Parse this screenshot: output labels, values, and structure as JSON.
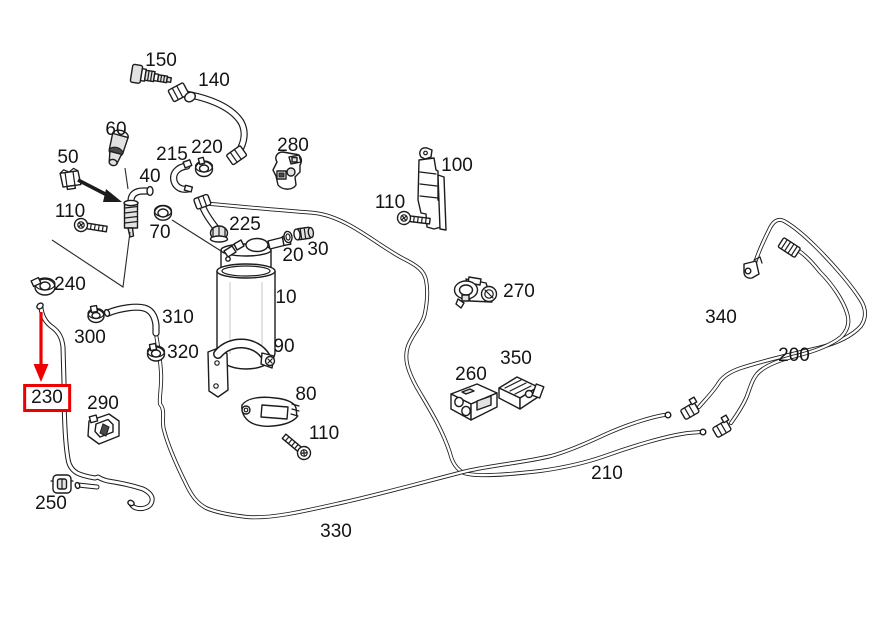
{
  "diagram": {
    "type": "exploded-parts-diagram",
    "background_color": "#ffffff",
    "line_color": "#1c1c1c",
    "highlight_color": "#ee0000",
    "highlighted_part": "230",
    "labels": [
      {
        "part": "150",
        "x": 161,
        "y": 61
      },
      {
        "part": "140",
        "x": 214,
        "y": 81
      },
      {
        "part": "60",
        "x": 116,
        "y": 130
      },
      {
        "part": "50",
        "x": 68,
        "y": 158
      },
      {
        "part": "215",
        "x": 172,
        "y": 155
      },
      {
        "part": "220",
        "x": 207,
        "y": 148
      },
      {
        "part": "280",
        "x": 293,
        "y": 146
      },
      {
        "part": "100",
        "x": 457,
        "y": 166
      },
      {
        "part": "110",
        "x": 390,
        "y": 203,
        "instance": "right"
      },
      {
        "part": "40",
        "x": 150,
        "y": 177
      },
      {
        "part": "110",
        "x": 70,
        "y": 212,
        "instance": "left"
      },
      {
        "part": "70",
        "x": 160,
        "y": 233
      },
      {
        "part": "225",
        "x": 245,
        "y": 225
      },
      {
        "part": "20",
        "x": 293,
        "y": 256
      },
      {
        "part": "30",
        "x": 318,
        "y": 250
      },
      {
        "part": "10",
        "x": 286,
        "y": 298
      },
      {
        "part": "240",
        "x": 70,
        "y": 285
      },
      {
        "part": "270",
        "x": 519,
        "y": 292
      },
      {
        "part": "300",
        "x": 90,
        "y": 338
      },
      {
        "part": "310",
        "x": 178,
        "y": 318
      },
      {
        "part": "320",
        "x": 183,
        "y": 353
      },
      {
        "part": "90",
        "x": 284,
        "y": 347
      },
      {
        "part": "340",
        "x": 721,
        "y": 318
      },
      {
        "part": "200",
        "x": 794,
        "y": 356
      },
      {
        "part": "350",
        "x": 516,
        "y": 359
      },
      {
        "part": "260",
        "x": 471,
        "y": 375
      },
      {
        "part": "230",
        "x": 47,
        "y": 398,
        "highlighted": true
      },
      {
        "part": "290",
        "x": 103,
        "y": 404
      },
      {
        "part": "80",
        "x": 306,
        "y": 395
      },
      {
        "part": "110",
        "x": 324,
        "y": 434,
        "instance": "bottom"
      },
      {
        "part": "250",
        "x": 51,
        "y": 504
      },
      {
        "part": "210",
        "x": 607,
        "y": 474
      },
      {
        "part": "330",
        "x": 336,
        "y": 532
      }
    ]
  }
}
